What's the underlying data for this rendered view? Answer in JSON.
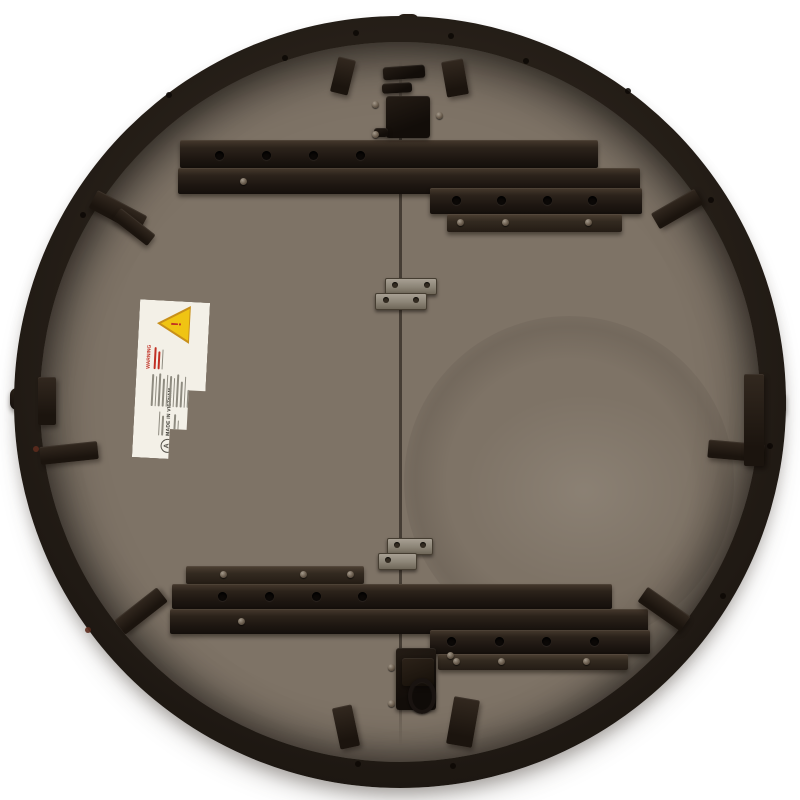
{
  "photo": {
    "subject": "Underside of a round wooden folding table",
    "background_color": "#ffffff",
    "wood_color": "#7e7366",
    "rim_color": "#241d17",
    "batten_color": "#1d1611",
    "hinge_metal_color": "#8b8476"
  },
  "warning_label": {
    "heading": "WARNING",
    "made_in": "MADE IN VIETNAM",
    "badge": "A",
    "exclamation": "!",
    "label_bg": "#f3f0e7",
    "triangle_color": "#f0c413",
    "accent_red": "#c13024"
  }
}
